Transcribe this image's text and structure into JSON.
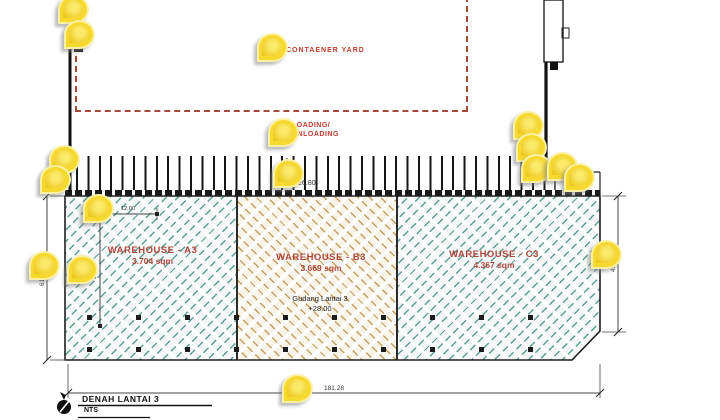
{
  "drawing": {
    "container_yard_label": "CONTAENER YARD",
    "loading_label_line1": "LOADING/",
    "loading_label_line2": "UNLOADING",
    "warehouses": [
      {
        "name": "WAREHOUSE - A3",
        "area": "3.704 sqm"
      },
      {
        "name": "WAREHOUSE - B3",
        "area": "3.669 sqm"
      },
      {
        "name": "WAREHOUSE - C3",
        "area": "4.367 sqm"
      }
    ],
    "floor_note_line1": "Gudang Lantai 3",
    "floor_note_line2": "+28.00",
    "dimensions": {
      "bottom_width": "181.28",
      "left_height": "61.07",
      "right_height": "49.28",
      "inner_width": "12.00",
      "inner_height": "36.50",
      "dock_level": "+26.80"
    },
    "title": "DENAH LANTAI 3",
    "scale_note": "NTS",
    "colors": {
      "label_red": "#c13a2c",
      "warehouse_label": "#b0453a",
      "hatch_teal": "#5f9e97",
      "hatch_tan": "#c2a066",
      "yard_dash": "#a34b38",
      "pin_yellow": "#f6d92e"
    },
    "pins": [
      {
        "x": 71,
        "y": 7
      },
      {
        "x": 77,
        "y": 32
      },
      {
        "x": 270,
        "y": 45
      },
      {
        "x": 281,
        "y": 130
      },
      {
        "x": 286,
        "y": 171
      },
      {
        "x": 62,
        "y": 157
      },
      {
        "x": 53,
        "y": 177
      },
      {
        "x": 96,
        "y": 206
      },
      {
        "x": 42,
        "y": 263
      },
      {
        "x": 80,
        "y": 267
      },
      {
        "x": 526,
        "y": 123
      },
      {
        "x": 529,
        "y": 145
      },
      {
        "x": 534,
        "y": 166
      },
      {
        "x": 560,
        "y": 164
      },
      {
        "x": 577,
        "y": 175
      },
      {
        "x": 604,
        "y": 252
      },
      {
        "x": 295,
        "y": 386
      }
    ]
  }
}
